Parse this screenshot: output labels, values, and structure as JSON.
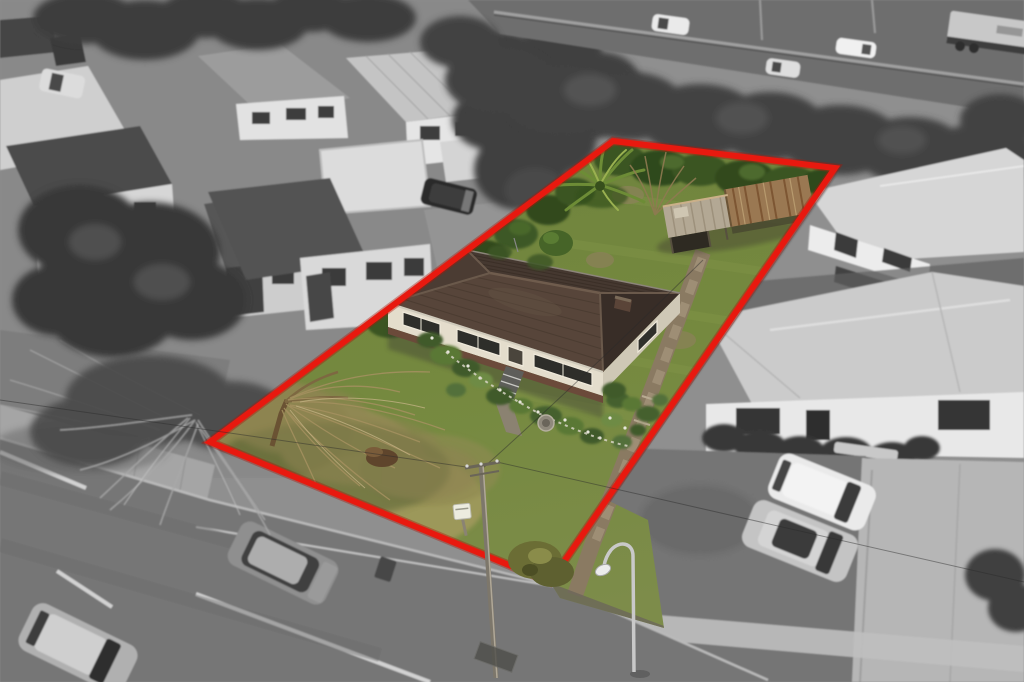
{
  "meta": {
    "media_type": "aerial drone photograph",
    "subject": "residential property for sale with highlighted lot boundary",
    "style": "subject lot rendered in colour, surrounding neighbourhood desaturated to grayscale",
    "width": 1024,
    "height": 682
  },
  "boundary_overlay": {
    "label": "property boundary outline",
    "color": "#e8190f",
    "underglow": "#b01408",
    "stroke_width": 6,
    "points": "613,141 835,168 550,582 210,442"
  },
  "palette": {
    "lawn_green": "#6f8440",
    "lawn_stripe": "#86994d",
    "dry_grass": "#958e55",
    "house_roof_front": "#57453a",
    "house_roof_back": "#453830",
    "house_wall": "#e4ddcc",
    "house_wall_shade": "#cfc8b6",
    "brick_base": "#6b4a3a",
    "shed_metal": "#b3a894",
    "shed_rust": "#9a7852",
    "path_concrete": "#8a7a62",
    "road_asphalt": "#767676",
    "sidewalk": "#a5a5a5",
    "driveway": "#b6b6b6",
    "highway_asphalt": "#6e6e6e",
    "tree_gray": "#3f3f3f",
    "shrub_green": "#3a5424",
    "vehicle_white": "#eaeaea"
  },
  "scene": {
    "property_lot": {
      "features": [
        "single-storey weatherboard house with dark hip roof",
        "front porch steps and flower garden beds",
        "rusted corrugated-iron shed at rear",
        "cabbage tree near rear lawn",
        "bare willow tree on front lawn",
        "long concrete side path to rear shed",
        "white letterbox",
        "shrub at front street corner"
      ]
    },
    "surroundings": {
      "top": "motorway with passing cars and a truck behind a dense tree belt",
      "left": "neighbouring houses, carports, parked van and car, large trees",
      "right": "white weatherboard neighbour houses, concrete driveway, two parked SUVs",
      "bottom": "suburban street with lane markings, parked cars, power pole and street light"
    },
    "vehicles": {
      "motorway": [
        "white car",
        "white car",
        "white car",
        "truck with light trailer"
      ],
      "street_parked": [
        "grey SUV",
        "grey wagon"
      ],
      "neighbour_driveway": [
        "white SUV",
        "silver SUV"
      ]
    }
  }
}
